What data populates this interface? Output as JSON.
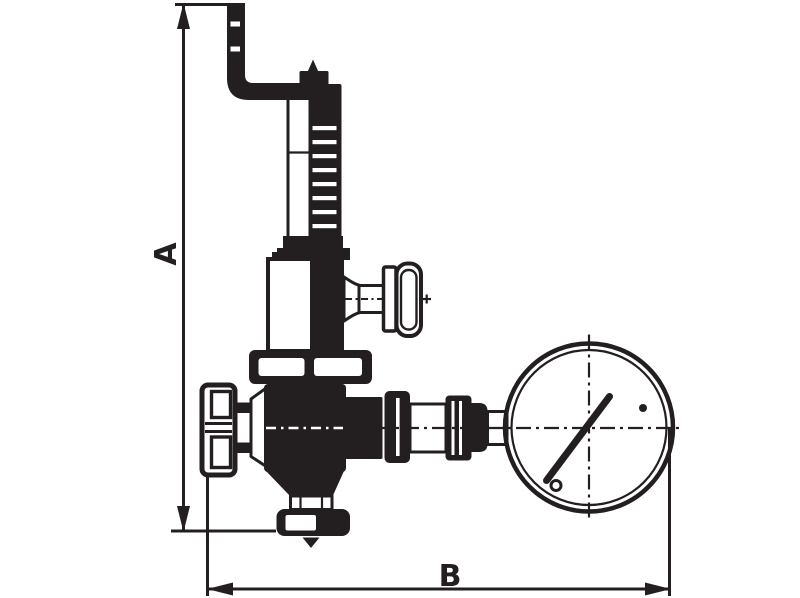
{
  "diagram": {
    "type": "technical-line-drawing",
    "subject": "pressure reducing valve with pressure gauge, dimensioned",
    "ink_color": "#231f20",
    "background_color": "#ffffff",
    "dimensions": {
      "vertical_label": "A",
      "horizontal_label": "B"
    },
    "parts": [
      "inlet-elbow-pipe",
      "adjusting-screw-cap",
      "spring-housing",
      "bonnet",
      "side-tap-tee-handle",
      "inlet-handwheel",
      "valve-body",
      "bottom-outlet-union",
      "outlet-piping",
      "pressure-gauge"
    ]
  }
}
